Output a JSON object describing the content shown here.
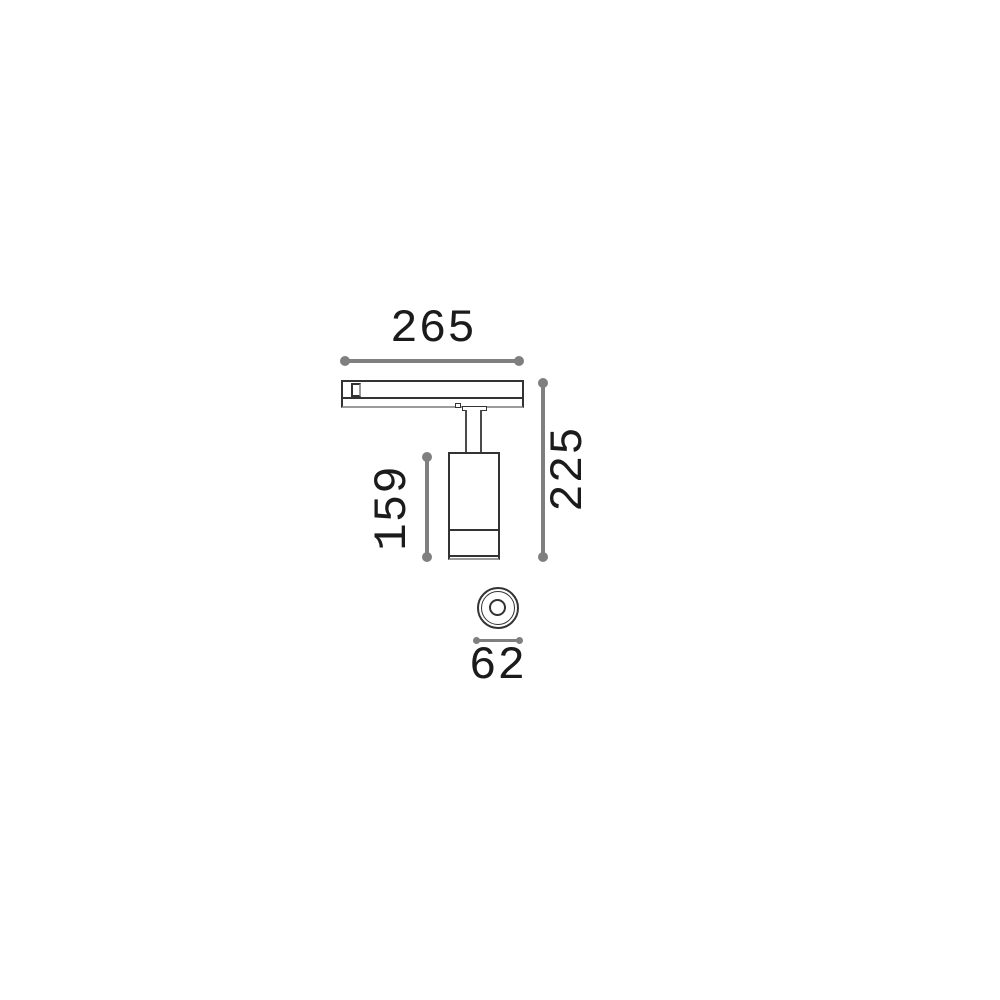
{
  "colors": {
    "background": "#ffffff",
    "stroke": "#333333",
    "shadow": "#9b9b9b",
    "dimension": "#7f7f7f",
    "text": "#1b1b1b"
  },
  "drawing": {
    "kind": "technical-dimension-drawing",
    "views": {
      "front": "track-mounted cylindrical spotlight, side view",
      "bottom": "circular lens, bottom view"
    },
    "dimensions": {
      "track_width": {
        "label": "265"
      },
      "total_height": {
        "label": "225"
      },
      "body_length": {
        "label": "159"
      },
      "body_diameter": {
        "label": "62"
      }
    }
  }
}
